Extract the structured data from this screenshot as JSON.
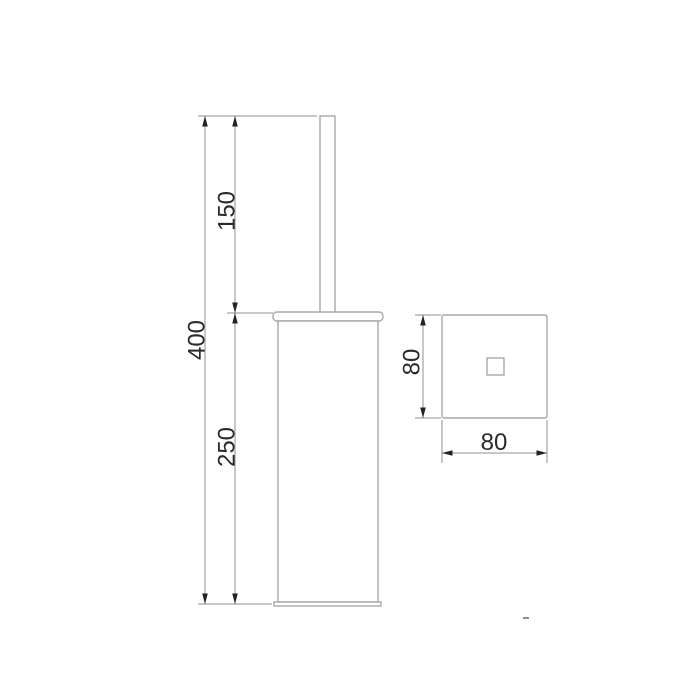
{
  "colors": {
    "background": "#ffffff",
    "object-line": "#a5a8aa",
    "dim-line": "#8f8f8f",
    "arrow": "#222222",
    "text": "#2a2a2a"
  },
  "front_view": {
    "description": "front elevation of toilet brush holder",
    "dims": {
      "total_height": "400",
      "handle_height": "150",
      "body_height": "250"
    }
  },
  "top_view": {
    "description": "top plan of holder body",
    "dims": {
      "depth": "80",
      "width": "80"
    }
  }
}
